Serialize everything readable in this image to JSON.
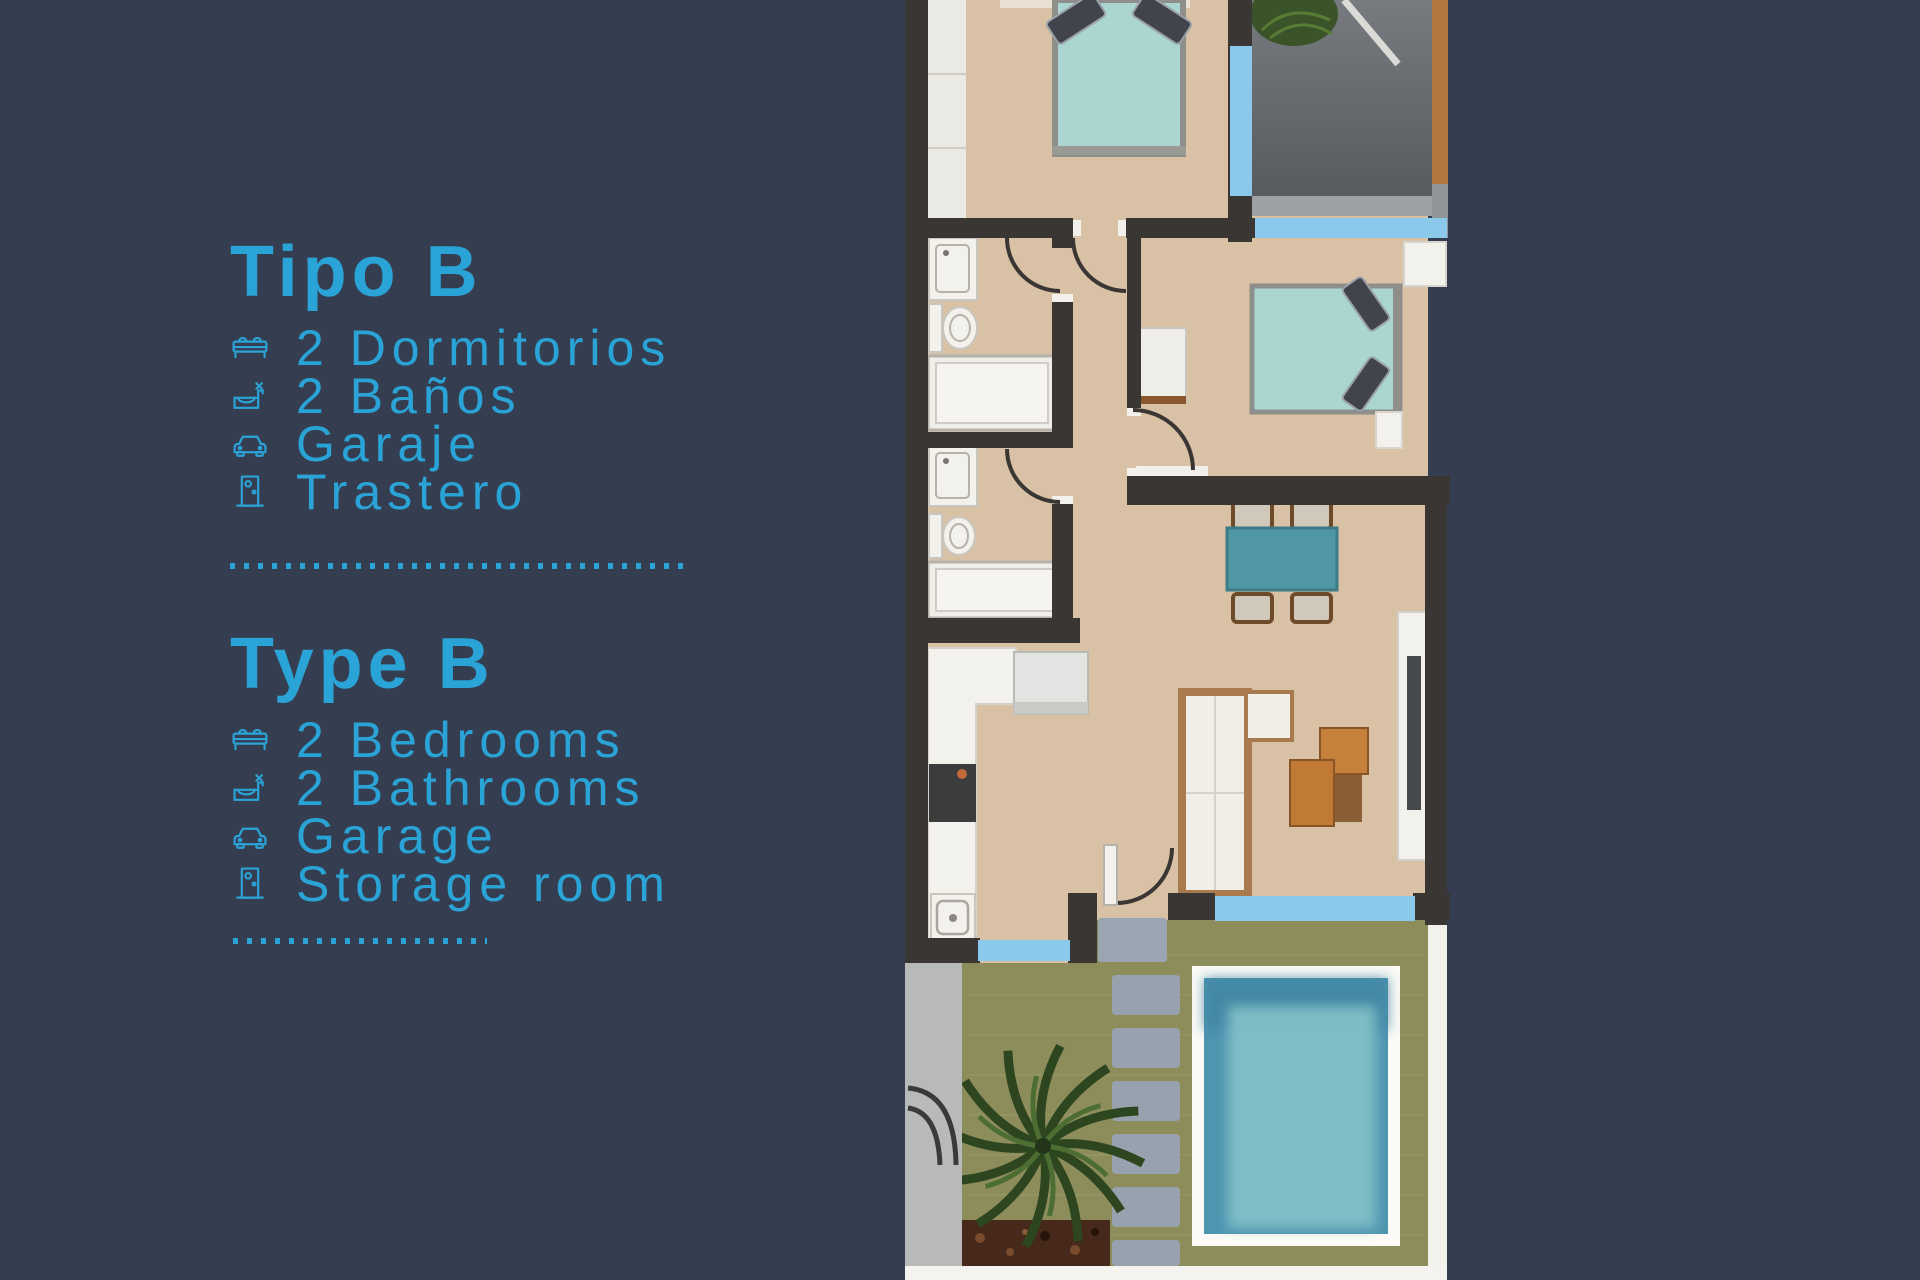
{
  "page": {
    "background_color": "#353e51",
    "accent_color": "#2aa3d6"
  },
  "panel": {
    "sections": [
      {
        "heading": "Tipo B",
        "items": [
          {
            "icon": "bed-icon",
            "label": "2 Dormitorios"
          },
          {
            "icon": "bathroom-icon",
            "label": "2 Baños"
          },
          {
            "icon": "car-icon",
            "label": "Garaje"
          },
          {
            "icon": "door-icon",
            "label": "Trastero"
          }
        ]
      },
      {
        "heading": "Type B",
        "items": [
          {
            "icon": "bed-icon",
            "label": "2 Bedrooms"
          },
          {
            "icon": "bathroom-icon",
            "label": "2 Bathrooms"
          },
          {
            "icon": "car-icon",
            "label": "Garage"
          },
          {
            "icon": "door-icon",
            "label": "Storage room"
          }
        ]
      }
    ]
  },
  "floorplan": {
    "colors": {
      "wall": "#3a3633",
      "floor": "#d8c1a5",
      "white_fixture": "#f3f1ec",
      "window_blue": "#8ac9ec",
      "bed_teal": "#abd5d1",
      "dining_table_teal": "#4f97a4",
      "garage_gray": "#6d7175",
      "garden_green": "#8d8d5c",
      "pool_water": "#4e95b0",
      "pool_water_light": "#85c2c9",
      "stepping_stone_gray": "#97a2ae",
      "sofa_wood": "#a97a4e",
      "coffee_table_orange": "#c5803c",
      "soil_brown": "#46291a",
      "concrete_gray": "#b7bab8"
    }
  }
}
